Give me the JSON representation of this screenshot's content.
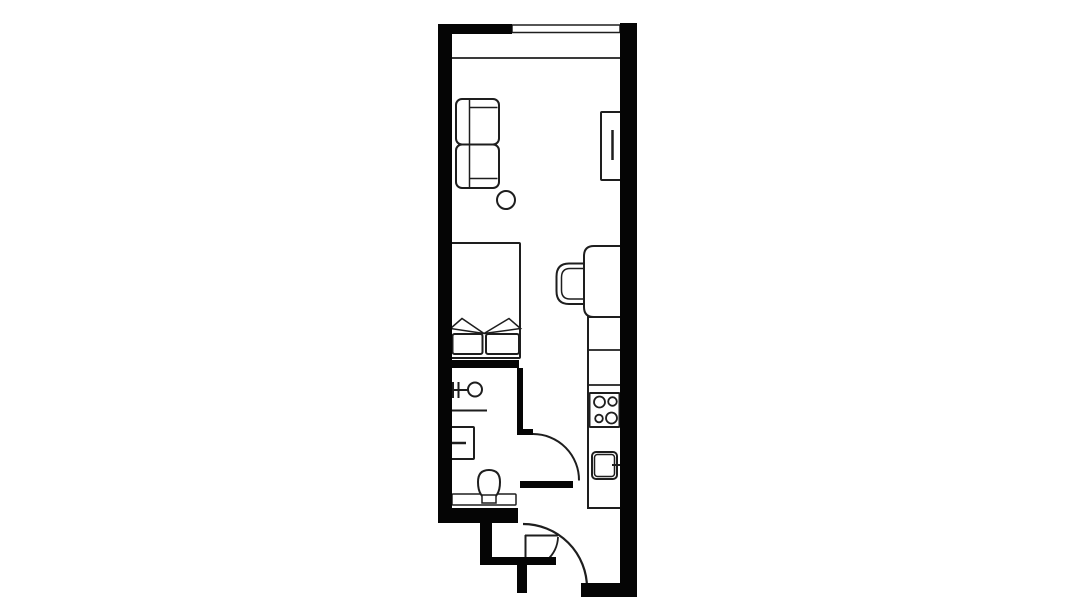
{
  "canvas": {
    "width": 1092,
    "height": 614,
    "background": "#ffffff",
    "wall_color": "#050505",
    "line_color": "#1e1e1e",
    "fill_color": "#ffffff"
  },
  "floor_plan": {
    "walls": [
      {
        "name": "left-wall",
        "x": 438,
        "y": 24,
        "w": 14,
        "h": 499
      },
      {
        "name": "top-wall",
        "x": 438,
        "y": 24,
        "w": 74,
        "h": 10
      },
      {
        "name": "right-wall",
        "x": 620,
        "y": 23,
        "w": 17,
        "h": 574
      },
      {
        "name": "bedroom-bathroom-divider-wall",
        "x": 438,
        "y": 360,
        "w": 81,
        "h": 8
      },
      {
        "name": "bathroom-right-wall",
        "x": 517,
        "y": 368,
        "w": 6,
        "h": 62
      },
      {
        "name": "bathroom-door-jamb",
        "x": 517,
        "y": 429,
        "w": 16,
        "h": 6
      },
      {
        "name": "bathroom-door-leaf",
        "x": 520,
        "y": 481,
        "w": 53,
        "h": 7
      },
      {
        "name": "bathroom-bottom-wall",
        "x": 438,
        "y": 508,
        "w": 80,
        "h": 15
      },
      {
        "name": "entry-step-wall-vertical-1",
        "x": 480,
        "y": 523,
        "w": 12,
        "h": 40
      },
      {
        "name": "entry-step-wall-horizontal",
        "x": 480,
        "y": 557,
        "w": 76,
        "h": 8
      },
      {
        "name": "entry-step-wall-vertical-2",
        "x": 517,
        "y": 565,
        "w": 10,
        "h": 28
      },
      {
        "name": "bottom-right-wall",
        "x": 581,
        "y": 583,
        "w": 56,
        "h": 14
      }
    ],
    "outlines": [
      {
        "name": "window",
        "x": 512,
        "y": 25,
        "w": 108,
        "h": 7.5,
        "rx": 0,
        "sw": 1.5
      },
      {
        "name": "sofa-seat-top",
        "x": 456,
        "y": 99,
        "w": 43,
        "h": 45.5,
        "rx": 6,
        "sw": 2
      },
      {
        "name": "sofa-seat-bottom",
        "x": 456,
        "y": 144.5,
        "w": 43,
        "h": 43.5,
        "rx": 6,
        "sw": 2
      },
      {
        "name": "tv-unit",
        "x": 601,
        "y": 112,
        "w": 20,
        "h": 68,
        "rx": 1,
        "sw": 2
      },
      {
        "name": "bed",
        "x": 450,
        "y": 243,
        "w": 70,
        "h": 115,
        "rx": 1,
        "sw": 2
      },
      {
        "name": "bed-cushion-left",
        "x": 452.5,
        "y": 334,
        "w": 30,
        "h": 20,
        "rx": 2,
        "sw": 2
      },
      {
        "name": "bed-cushion-right",
        "x": 486,
        "y": 334,
        "w": 33,
        "h": 20,
        "rx": 2,
        "sw": 2
      },
      {
        "name": "kitchen-counter",
        "x": 588,
        "y": 317,
        "w": 33,
        "h": 191,
        "rx": 0,
        "sw": 2
      },
      {
        "name": "stove",
        "x": 589.5,
        "y": 393,
        "w": 30,
        "h": 34,
        "rx": 1,
        "sw": 2
      },
      {
        "name": "kitchen-sink-outer",
        "x": 592,
        "y": 452,
        "w": 25,
        "h": 27,
        "rx": 4,
        "sw": 2
      },
      {
        "name": "kitchen-sink-inner",
        "x": 594.5,
        "y": 454.5,
        "w": 20,
        "h": 22,
        "rx": 3,
        "sw": 1.5
      },
      {
        "name": "bathroom-sink",
        "x": 451,
        "y": 427,
        "w": 23,
        "h": 32,
        "rx": 1,
        "sw": 2
      },
      {
        "name": "toilet-cistern",
        "x": 452,
        "y": 494,
        "w": 64,
        "h": 11,
        "rx": 1,
        "sw": 1.5
      }
    ],
    "circles": [
      {
        "name": "side-table",
        "cx": 506,
        "cy": 200,
        "r": 9,
        "sw": 2
      },
      {
        "name": "shower-head",
        "cx": 475,
        "cy": 389.5,
        "r": 7,
        "sw": 2
      },
      {
        "name": "stove-burner-top-left",
        "cx": 599.5,
        "cy": 402,
        "r": 5.5,
        "sw": 1.8
      },
      {
        "name": "stove-burner-top-right",
        "cx": 612.5,
        "cy": 401.5,
        "r": 4.3,
        "sw": 1.8
      },
      {
        "name": "stove-burner-bottom-left",
        "cx": 599,
        "cy": 418.5,
        "r": 3.8,
        "sw": 1.8
      },
      {
        "name": "stove-burner-bottom-right",
        "cx": 611.5,
        "cy": 418,
        "r": 5.5,
        "sw": 1.8
      }
    ],
    "lines": [
      {
        "name": "window-ledge-line",
        "x1": 452,
        "y1": 58,
        "x2": 620,
        "y2": 58,
        "sw": 1.8
      },
      {
        "name": "sofa-back-line",
        "x1": 469.5,
        "y1": 100,
        "x2": 469.5,
        "y2": 187,
        "sw": 1.5
      },
      {
        "name": "sofa-armrest-line-top",
        "x1": 469.5,
        "y1": 107.5,
        "x2": 497.5,
        "y2": 107.5,
        "sw": 1.5
      },
      {
        "name": "sofa-armrest-line-bottom",
        "x1": 469.5,
        "y1": 178.5,
        "x2": 497.5,
        "y2": 178.5,
        "sw": 1.5
      },
      {
        "name": "tv-screen-line",
        "x1": 612.5,
        "y1": 130,
        "x2": 612.5,
        "y2": 160,
        "sw": 2.5
      },
      {
        "name": "counter-divider-line-1",
        "x1": 588,
        "y1": 350,
        "x2": 620,
        "y2": 350,
        "sw": 1.8
      },
      {
        "name": "counter-divider-line-2",
        "x1": 588,
        "y1": 385,
        "x2": 620,
        "y2": 385,
        "sw": 1.8
      },
      {
        "name": "kitchen-tap-line",
        "x1": 612,
        "y1": 465,
        "x2": 620,
        "y2": 465,
        "sw": 2
      },
      {
        "name": "shower-pipe-line",
        "x1": 452,
        "y1": 390,
        "x2": 468,
        "y2": 390,
        "sw": 2
      },
      {
        "name": "shower-valve-tick-1",
        "x1": 453,
        "y1": 382,
        "x2": 453,
        "y2": 398,
        "sw": 2
      },
      {
        "name": "shower-valve-tick-2",
        "x1": 458.5,
        "y1": 382,
        "x2": 458.5,
        "y2": 398,
        "sw": 2
      },
      {
        "name": "shower-screen-line",
        "x1": 451,
        "y1": 410.5,
        "x2": 487,
        "y2": 410.5,
        "sw": 2
      },
      {
        "name": "bathroom-tap-line",
        "x1": 452,
        "y1": 443,
        "x2": 466,
        "y2": 443,
        "sw": 2.5
      },
      {
        "name": "entry-closet-door-line-h",
        "x1": 525,
        "y1": 535.5,
        "x2": 558,
        "y2": 535.5,
        "sw": 2
      },
      {
        "name": "entry-closet-door-line-v",
        "x1": 525.5,
        "y1": 535,
        "x2": 525.5,
        "y2": 557,
        "sw": 2
      }
    ],
    "paths": [
      {
        "name": "desk",
        "d": "M 621 246 H 594 Q 584 246 584 256 V 307 Q 584 317 594 317 H 621 Z",
        "fill": "#ffffff",
        "sw": 2
      },
      {
        "name": "desk-chair-back-outer",
        "d": "M 584 263.5 H 569 Q 556.5 263.5 556.5 276.5 V 291 Q 556.5 304 569 304 H 584",
        "fill": "none",
        "sw": 2
      },
      {
        "name": "desk-chair-back-inner",
        "d": "M 584 268.5 H 570 Q 561.5 268.5 561.5 277.5 V 290 Q 561.5 299 570 299 H 584",
        "fill": "none",
        "sw": 1.5
      },
      {
        "name": "bed-pillow-left",
        "d": "M 450.5 328.5 L 462 318.5 L 484 333.5 Z",
        "fill": "#ffffff",
        "sw": 1.5
      },
      {
        "name": "bed-pillow-right",
        "d": "M 520.5 328.5 L 509 318.5 L 484 333.5 Z",
        "fill": "#ffffff",
        "sw": 1.5
      },
      {
        "name": "toilet-bowl",
        "d": "M 478 482 Q 478 470 489 470 Q 500 470 500 482 Q 500 490 497 494.5 Q 494 499.5 489 499.5 Q 484 499.5 481 494.5 Q 478 490 478 482 Z",
        "fill": "#ffffff",
        "sw": 2
      },
      {
        "name": "toilet-seat-hinge",
        "d": "M 482 495 H 496 V 503 H 482 Z",
        "fill": "#ffffff",
        "sw": 1.5
      },
      {
        "name": "bathroom-door-arc",
        "d": "M 533 434 A 46 46 0 0 1 579 480.5",
        "fill": "none",
        "sw": 2
      },
      {
        "name": "entry-door-arc",
        "d": "M 523 524 A 64 64 0 0 1 587 588",
        "fill": "none",
        "sw": 2.2
      },
      {
        "name": "entry-closet-door-arc",
        "d": "M 558 537 A 31 31 0 0 1 547 560",
        "fill": "none",
        "sw": 1.8
      }
    ]
  }
}
